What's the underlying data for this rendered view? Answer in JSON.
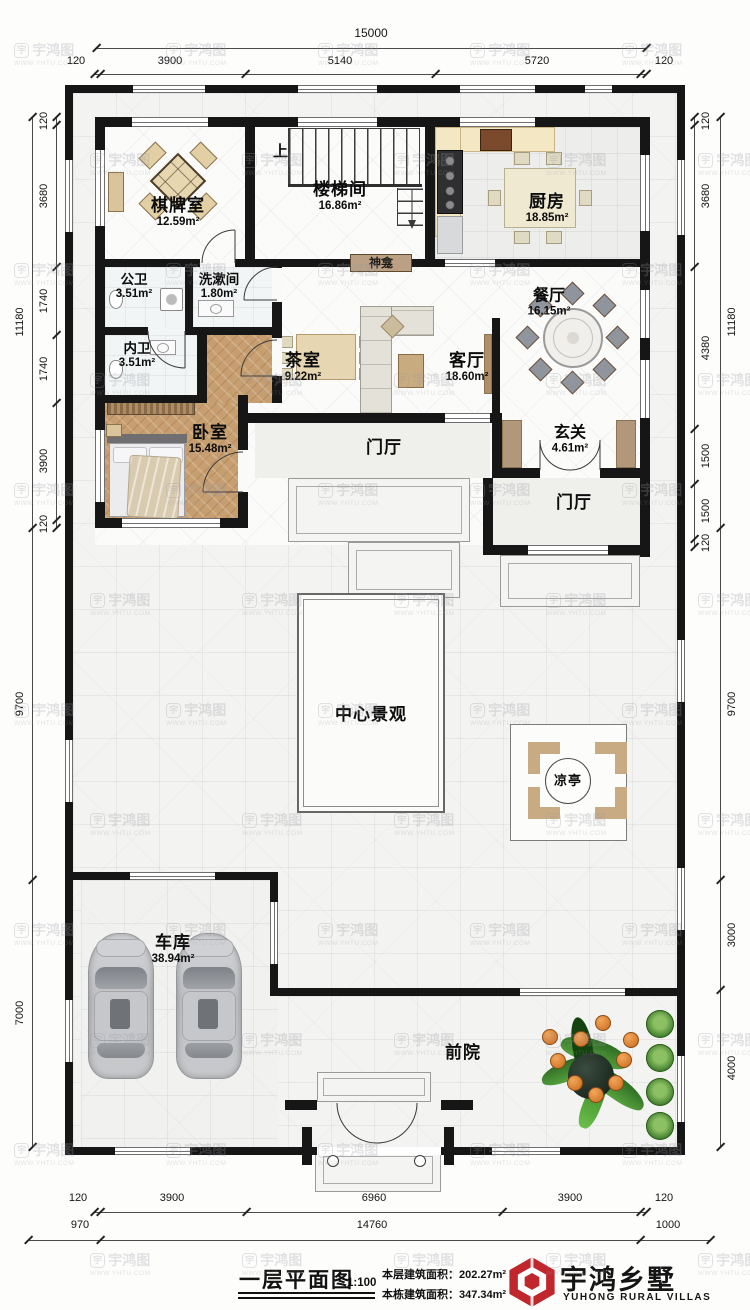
{
  "watermark": {
    "mark": "宇鸿图",
    "url": "WWW.YHTU.COM"
  },
  "dims": {
    "top": {
      "total": "15000",
      "segments": [
        "120",
        "3900",
        "5140",
        "5720",
        "120"
      ]
    },
    "bottom": {
      "segments": [
        "120",
        "3900",
        "6960",
        "3900",
        "120"
      ],
      "overall": [
        "970",
        "14760",
        "1000"
      ]
    },
    "left": {
      "segments": [
        "120",
        "3680",
        "1740",
        "1740",
        "3900",
        "120"
      ],
      "overall": [
        "11180",
        "9700",
        "7000"
      ]
    },
    "right": {
      "segments": [
        "120",
        "3680",
        "4380",
        "1500",
        "1500",
        "120"
      ],
      "overall": [
        "11180",
        "9700",
        "3000",
        "4000"
      ]
    }
  },
  "rooms": [
    {
      "name": "棋牌室",
      "area": "12.59m²"
    },
    {
      "name": "楼梯间",
      "area": "16.86m²"
    },
    {
      "name": "厨房",
      "area": "18.85m²"
    },
    {
      "name": "公卫",
      "area": "3.51m²"
    },
    {
      "name": "洗漱间",
      "area": "1.80m²"
    },
    {
      "name": "餐厅",
      "area": "16.15m²"
    },
    {
      "name": "内卫",
      "area": "3.51m²"
    },
    {
      "name": "茶室",
      "area": "9.22m²"
    },
    {
      "name": "客厅",
      "area": "18.60m²"
    },
    {
      "name": "卧室",
      "area": "15.48m²"
    },
    {
      "name": "玄关",
      "area": "4.61m²"
    },
    {
      "name": "门厅",
      "area": ""
    },
    {
      "name": "门厅",
      "area": ""
    },
    {
      "name": "中心景观",
      "area": ""
    },
    {
      "name": "凉亭",
      "area": ""
    },
    {
      "name": "车库",
      "area": "38.94m²"
    },
    {
      "name": "前院",
      "area": ""
    }
  ],
  "annotations": {
    "stairs_up": "上",
    "shrine": "神龛"
  },
  "title_block": {
    "drawing_title": "一层平面图",
    "scale": "1:100",
    "floor_area_label": "本层建筑面积：",
    "floor_area_value": "202.27m²",
    "total_area_label": "本栋建筑面积：",
    "total_area_value": "347.34m²",
    "brand_cn": "宇鸿乡墅",
    "brand_en": "YUHONG RURAL VILLAS"
  },
  "colors": {
    "brand_red": "#c0272d",
    "wall": "#161616",
    "wood": "#c79e6f",
    "accent_tan": "#d9c49c"
  }
}
